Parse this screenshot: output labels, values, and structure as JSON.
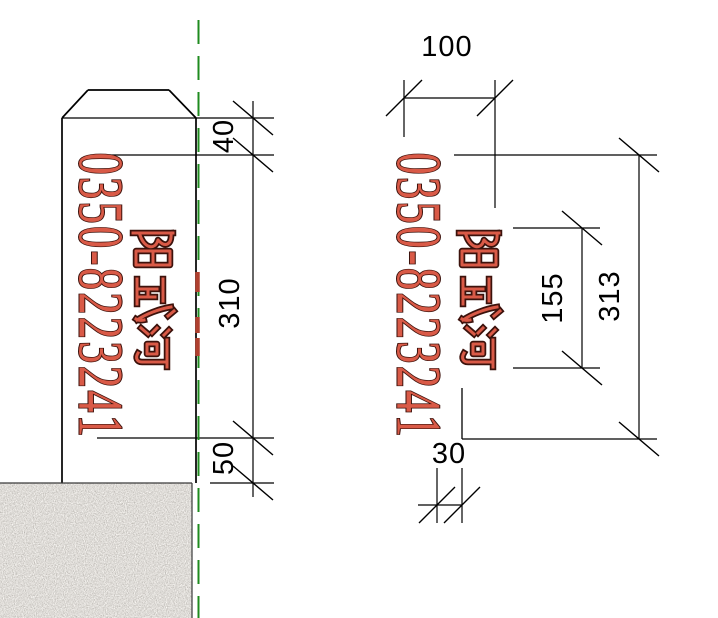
{
  "post_label": {
    "phone": "0350-8223241",
    "river_name": "阳武河"
  },
  "dimensions": {
    "left_view": {
      "top_to_text": "40",
      "text_band_height": "310",
      "text_to_ground": "50"
    },
    "right_view": {
      "post_width": "100",
      "river_name_height": "155",
      "label_total_height": "313",
      "side_offset": "30"
    }
  },
  "colors": {
    "label_red": "#d95a47",
    "label_outline": "#3c120c",
    "centerline_green": "#1f8b1f",
    "drawing_lines": "#000000",
    "ground_base": "#c5bfb5"
  }
}
